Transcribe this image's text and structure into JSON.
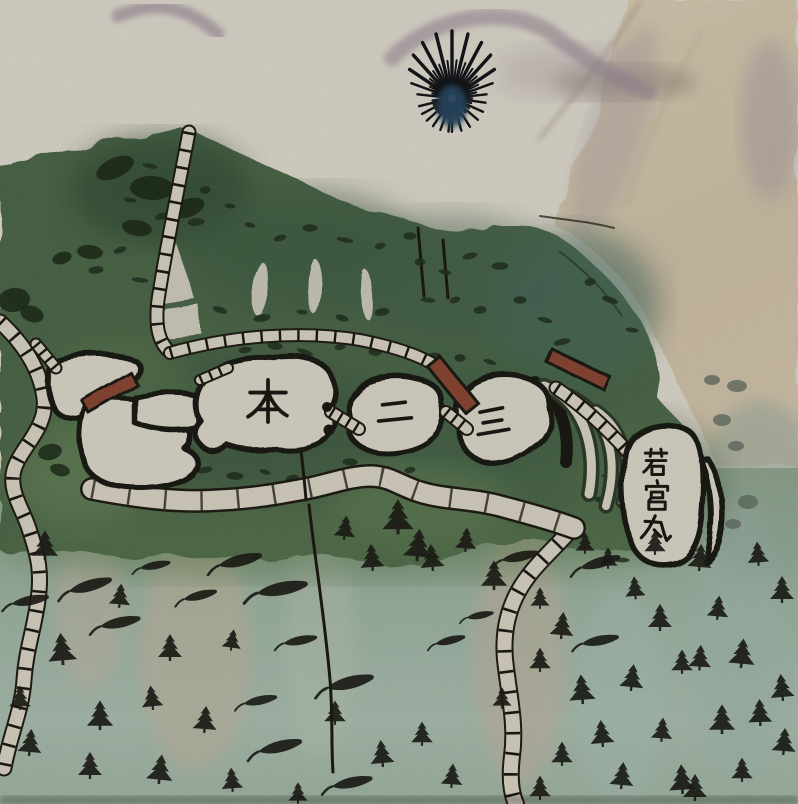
{
  "painting": {
    "labels": {
      "honmaru": "本",
      "ninomaru": "二",
      "sannomaru": "三",
      "wakamiya_maru": "若宮丸",
      "wakamiya_chars": [
        "若",
        "宮",
        "丸"
      ]
    },
    "palette": {
      "paper": "#ddd8cc",
      "mountain_wash": "#9a8c98",
      "slope_beige": "#cfc0a6",
      "forest_green": "#4e6849",
      "forest_dark": "#2f4630",
      "meadow_green": "#7f9668",
      "slope_blue_green": "#a3b8ad",
      "enclosure_fill": "#d9d5c8",
      "ink": "#1d1a14",
      "gate_red": "#8a4734",
      "tree_black": "#1e1e18",
      "pine_blue": "#2c4a64"
    }
  }
}
